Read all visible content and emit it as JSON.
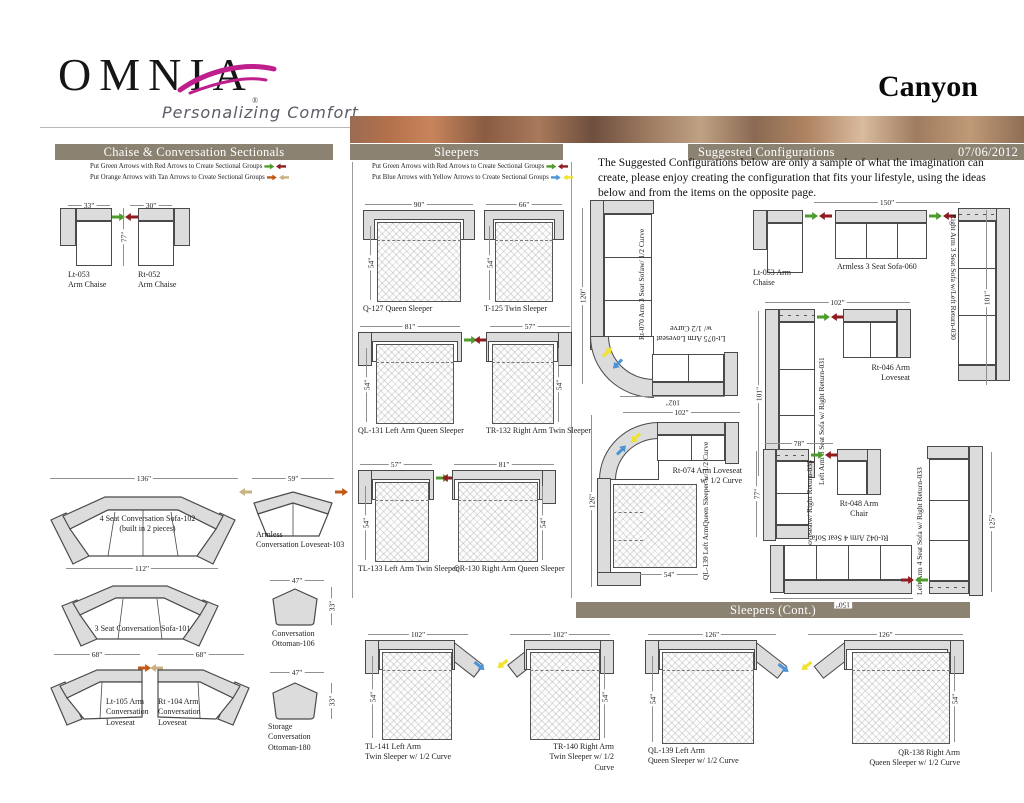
{
  "brand": {
    "name": "OMNIA",
    "reg": "®",
    "tagline": "Personalizing Comfort"
  },
  "page": {
    "title": "Canyon",
    "date": "07/06/2012"
  },
  "sections": {
    "chaise": "Chaise & Conversation Sectionals",
    "sleepers": "Sleepers",
    "suggested": "Suggested Configurations",
    "sleepers_cont": "Sleepers (Cont.)"
  },
  "legend": {
    "green_red": "Put Green Arrows with Red Arrows to Create Sectional Groups",
    "orange_tan": "Put Orange Arrows with Tan Arrows to Create Sectional Groups",
    "green_red2": "Put Green Arrows with Red Arrows to Create Sectional Groups",
    "blue_yellow": "Put Blue Arrows with Yellow Arrows to Create Sectional Groups"
  },
  "intro": "The Suggested Configurations below are only a sample of what the imagination can create, please enjoy creating the configuration that fits your lifestyle, using the ideas below and from the items on the opposite page.",
  "colors": {
    "bar": "#8b8272",
    "green": "#4e9b2e",
    "red": "#8f1c20",
    "orange": "#c25a17",
    "tan": "#c9b183",
    "blue": "#4e93d6",
    "yellow": "#efe32e",
    "magenta": "#bf1e8d"
  },
  "items": {
    "lt053": {
      "code": "Lt-053",
      "name": "Arm Chaise",
      "w": "33\"",
      "h": "77\""
    },
    "rt052": {
      "code": "Rt-052",
      "name": "Arm Chaise",
      "w": "30\""
    },
    "sofa102": {
      "name": "4 Seat Conversation Sofa-102",
      "note": "(built in 2 pieces)",
      "w": "136\""
    },
    "love103": {
      "name1": "Armless",
      "name2": "Conversation Loveseat-103",
      "w": "59\""
    },
    "sofa101": {
      "name": "3 Seat Conversation Sofa-101",
      "w": "112\""
    },
    "ott106": {
      "name1": "Conversation",
      "name2": "Ottoman-106",
      "w": "47\"",
      "h": "33\""
    },
    "lt105": {
      "name1": "Lt-105 Arm",
      "name2": "Conversation",
      "name3": "Loveseat",
      "w": "68\""
    },
    "rt104": {
      "name1": "Rt -104 Arm",
      "name2": "Conversation",
      "name3": "Loveseat",
      "w": "68\""
    },
    "ott180": {
      "name1": "Storage",
      "name2": "Conversation",
      "name3": "Ottoman-180",
      "w": "47\"",
      "h": "33\""
    },
    "q127": {
      "name": "Q-127 Queen Sleeper",
      "w": "90\"",
      "d": "54\""
    },
    "t125": {
      "name": "T-125 Twin Sleeper",
      "w": "66\"",
      "d": "54\""
    },
    "ql131": {
      "name": "QL-131 Left Arm Queen Sleeper",
      "w": "81\"",
      "d": "54\""
    },
    "tr132": {
      "name": "TR-132 Right Arm Twin Sleeper",
      "w": "57\"",
      "d": "54\""
    },
    "tl133": {
      "name": "TL-133 Left Arm Twin Sleeper",
      "w": "57\"",
      "d": "54\""
    },
    "qr130": {
      "name": "QR-130 Right Arm Queen Sleeper",
      "w": "81\"",
      "d": "54\""
    },
    "tl141": {
      "name1": "TL-141 Left Arm",
      "name2": "Twin Sleeper w/ 1/2 Curve",
      "w": "102\"",
      "d": "54\""
    },
    "tr140": {
      "name1": "TR-140 Right Arm",
      "name2": "Twin Sleeper w/ 1/2 Curve",
      "w": "102\"",
      "d": "54\""
    },
    "ql139": {
      "name1": "QL-139 Left Arm",
      "name2": "Queen Sleeper w/ 1/2 Curve",
      "w": "126\"",
      "d": "54\""
    },
    "qr138": {
      "name1": "QR-138 Right Arm",
      "name2": "Queen Sleeper w/ 1/2 Curve",
      "w": "126\"",
      "d": "54\""
    }
  },
  "configs": {
    "cfg1": {
      "sofa": "Rt-070 Arm 3 Seat Sofa",
      "sofa2": "w/ 1/2 Curve",
      "love": "Lt-075 Arm Loveseat",
      "love2": "w/ 1/2 Curve",
      "h": "120\"",
      "w": "102\""
    },
    "cfg2": {
      "chaise1": "Lt-053 Arm",
      "chaise2": "Chaise",
      "sofa": "Armless 3 Seat Sofa-060",
      "vert": "Right Arm 3 Seat Sofa w/Left Return-030",
      "w": "150\"",
      "h": "101\""
    },
    "cfg3": {
      "vert": "Left Arm 3 Seat Sofa w/ Right Return-031",
      "love1": "Rt-046 Arm",
      "love2": "Loveseat",
      "w": "102\"",
      "h": "101\""
    },
    "cfg4": {
      "love1": "Rt-074 Arm Loveseat",
      "love2": "w/ 1/2 Curve",
      "sleeper1": "QL-139 Left Arm",
      "sleeper2": "Queen Sleeper w/ 1/2 Curve",
      "w": "102\"",
      "h": "126\"",
      "bed": "54\""
    },
    "cfg5": {
      "vert1": "Left Arm Loveseat",
      "vert2": "w/ Right Return-035",
      "chair1": "Rt-048 Arm",
      "chair2": "Chair",
      "w": "78\"",
      "h": "77\""
    },
    "cfg6": {
      "sofa": "Rt-042 Arm 4 Seat Sofa",
      "vert": "Left Arm 4 Seat Sofa w/ Right Return-033",
      "w": "150\"",
      "h": "125\""
    }
  }
}
